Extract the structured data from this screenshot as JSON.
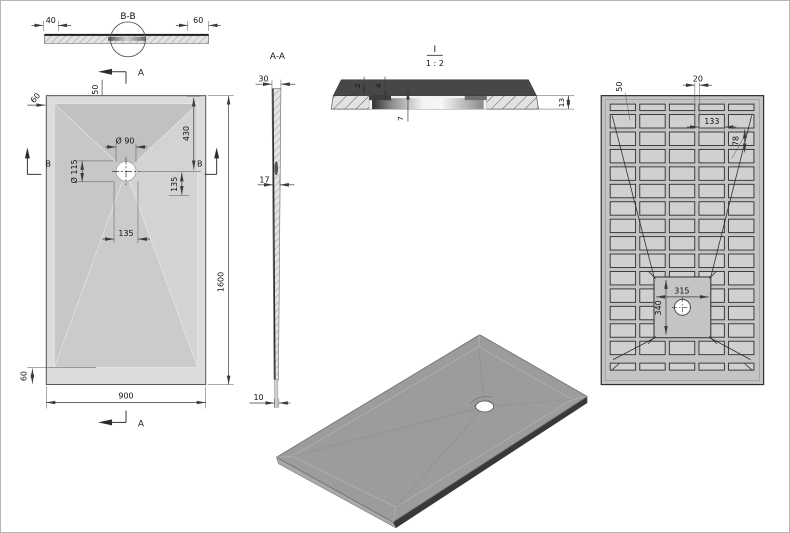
{
  "drawing": {
    "section_bb": {
      "title": "B-B",
      "dim_left": "40",
      "dim_right": "60"
    },
    "section_marks": {
      "a_top": "A",
      "a_bottom": "A",
      "b_left": "B",
      "b_right": "B"
    },
    "plan": {
      "dim_rim_top": "50",
      "dim_edge_top": "60",
      "dim_drain": "Ø 90",
      "dim_flange": "Ø 115",
      "dim_430": "430",
      "dim_135_v": "135",
      "dim_135_h": "135",
      "dim_length": "1600",
      "dim_width": "900",
      "dim_rim_bottom": "60"
    },
    "section_aa": {
      "title": "A-A",
      "dim_top": "30",
      "dim_mid": "17",
      "dim_bottom": "10"
    },
    "detail_i": {
      "title": "I",
      "scale": "1 : 2",
      "dim_2": "2",
      "dim_4": "4",
      "dim_7": "7",
      "dim_13": "13"
    },
    "bottom_view": {
      "dim_rib": "50",
      "dim_gap": "20",
      "dim_pocket_w": "133",
      "dim_pocket_h": "78",
      "dim_square_w": "315",
      "dim_square_h": "340",
      "grid": {
        "cols": 5,
        "main_rows": 14
      }
    }
  },
  "colors": {
    "line": "#3a3a3a",
    "tray_rim": "#dcdcdc",
    "facet_top": "#c1c1c1",
    "facet_right": "#d3d3d3",
    "facet_bottom": "#cbcbcb",
    "facet_left": "#c7c7c7",
    "section_dark": "#474747",
    "iso_top": "#9c9c9c",
    "iso_side_dark": "#383838",
    "iso_side_light": "#a8a8a8",
    "bottom_frame": "#c4c4c4",
    "pocket_fill": "#d0d0d0"
  }
}
